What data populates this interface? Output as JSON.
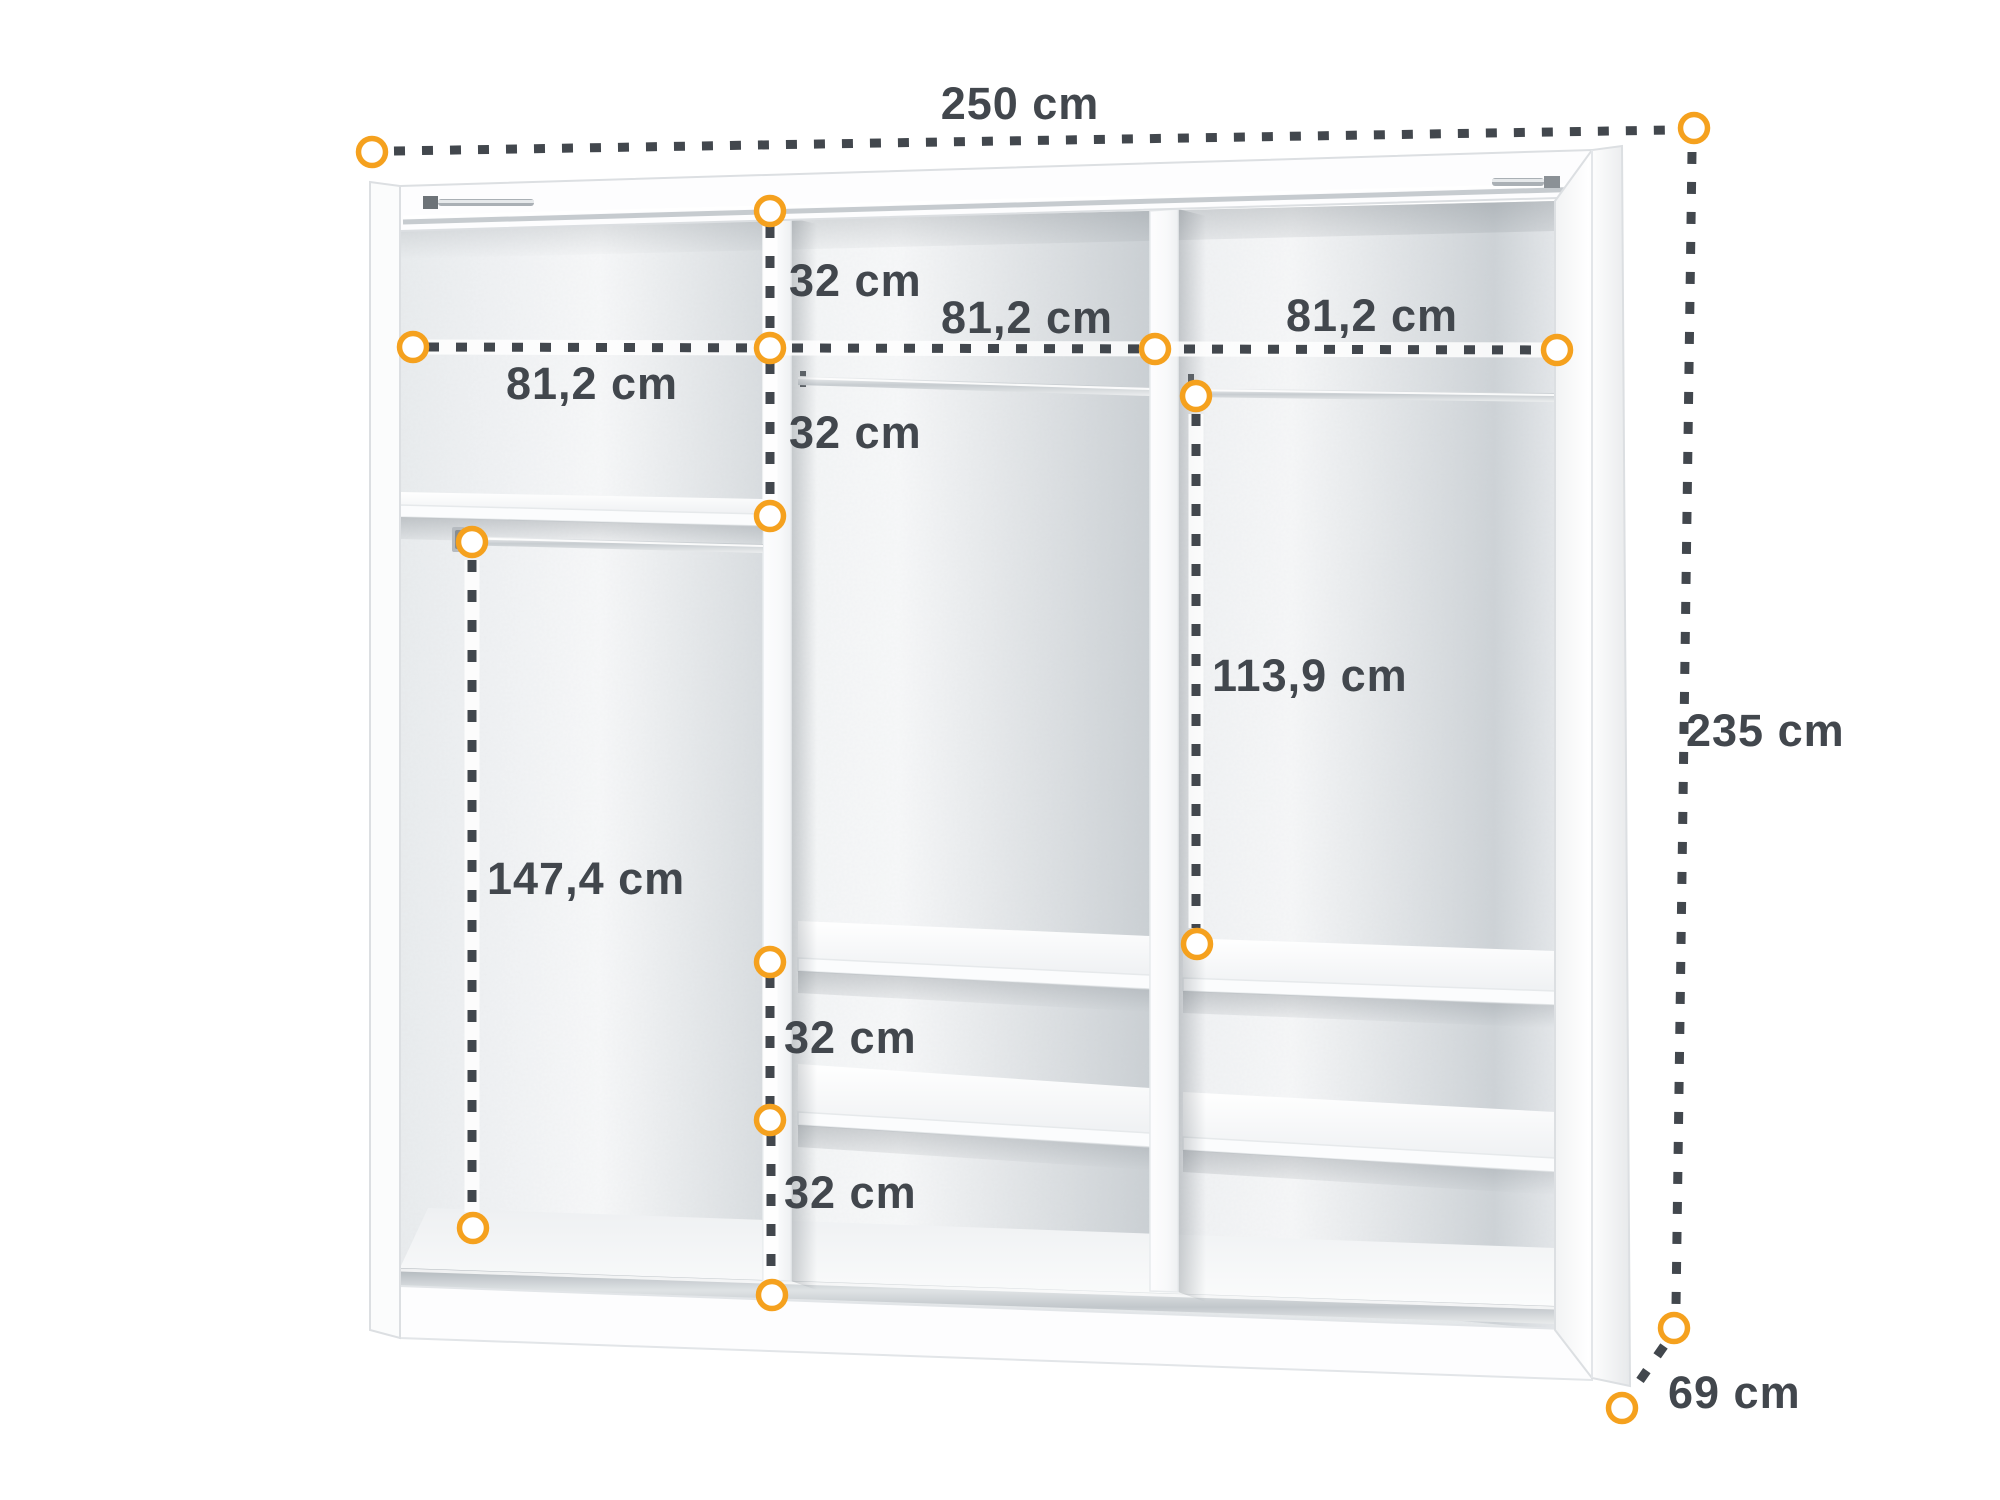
{
  "diagram": {
    "title": "wardrobe interior dimensions",
    "units": "cm",
    "accent_color": "#F5A11E",
    "dash_color": "#42474D",
    "text_color": "#42474D",
    "dimensions": {
      "total_width": {
        "label": "250 cm",
        "value": 250,
        "orientation": "horizontal-top"
      },
      "total_height": {
        "label": "235 cm",
        "value": 235,
        "orientation": "vertical-right"
      },
      "total_depth": {
        "label": "69 cm",
        "value": 69,
        "orientation": "diagonal-bottom-right"
      },
      "section_width_left": {
        "label": "81,2 cm",
        "value": 81.2,
        "orientation": "horizontal"
      },
      "section_width_middle": {
        "label": "81,2 cm",
        "value": 81.2,
        "orientation": "horizontal"
      },
      "section_width_right": {
        "label": "81,2 cm",
        "value": 81.2,
        "orientation": "horizontal"
      },
      "gap_top_to_line": {
        "label": "32 cm",
        "value": 32,
        "orientation": "vertical"
      },
      "gap_line_to_shelf": {
        "label": "32 cm",
        "value": 32,
        "orientation": "vertical"
      },
      "gap_shelf_upper": {
        "label": "32 cm",
        "value": 32,
        "orientation": "vertical"
      },
      "gap_shelf_lower": {
        "label": "32 cm",
        "value": 32,
        "orientation": "vertical"
      },
      "hanging_space_left": {
        "label": "147,4 cm",
        "value": 147.4,
        "orientation": "vertical"
      },
      "hanging_space_right": {
        "label": "113,9 cm",
        "value": 113.9,
        "orientation": "vertical"
      }
    }
  }
}
